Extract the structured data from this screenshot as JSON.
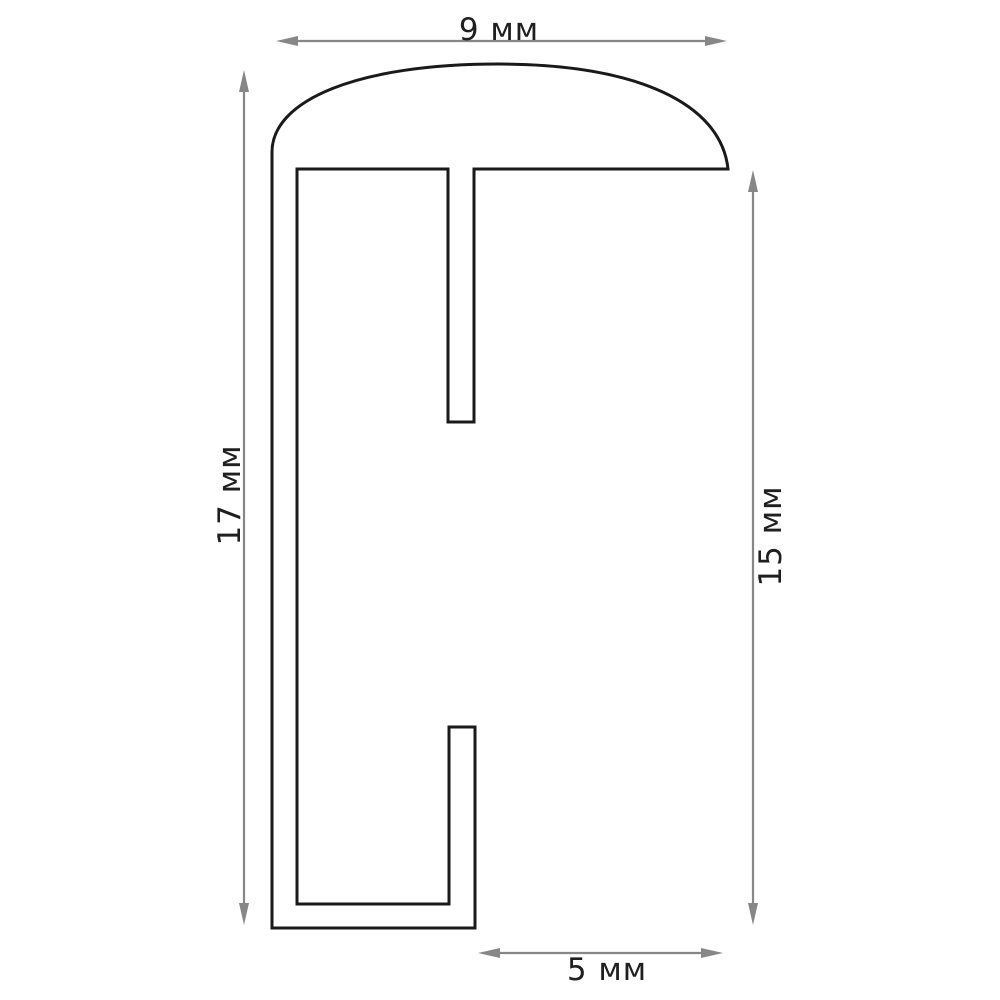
{
  "drawing": {
    "kind": "profile-cross-section",
    "unit": "мм",
    "dimensions": {
      "top_width": {
        "label": "9 мм",
        "value": 9,
        "unit": "мм",
        "orientation": "horizontal"
      },
      "left_height": {
        "label": "17 мм",
        "value": 17,
        "unit": "мм",
        "orientation": "vertical"
      },
      "right_height": {
        "label": "15 мм",
        "value": 15,
        "unit": "мм",
        "orientation": "vertical"
      },
      "bottom_width": {
        "label": "5 мм",
        "value": 5,
        "unit": "мм",
        "orientation": "horizontal"
      }
    },
    "colors": {
      "outline": "#1a1a1a",
      "dimension_lines": "#878787",
      "text": "#1f1f1f",
      "background": "#ffffff"
    }
  }
}
